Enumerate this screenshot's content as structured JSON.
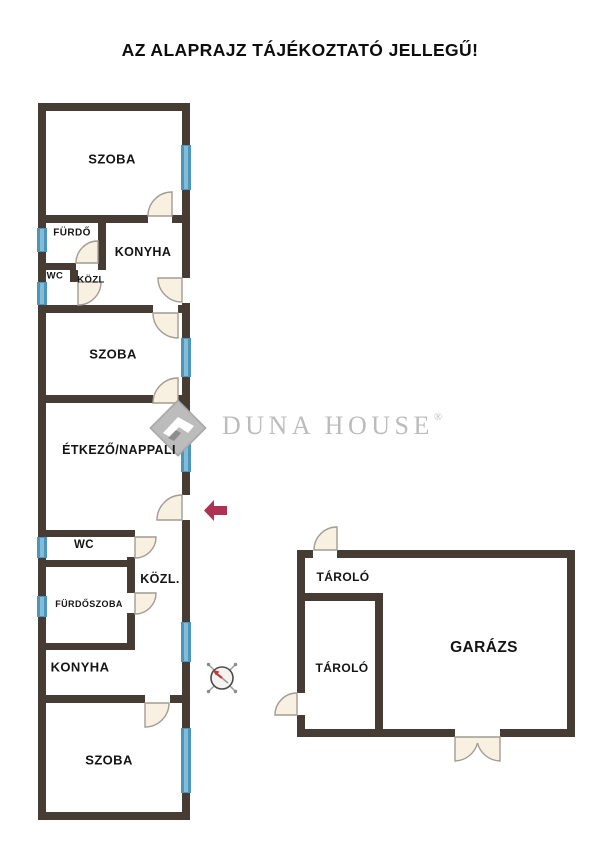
{
  "title": "AZ ALAPRAJZ TÁJÉKOZTATÓ JELLEGŰ!",
  "watermark": {
    "brand": "DUNA HOUSE",
    "registered": "®"
  },
  "floorplan": {
    "main_building": {
      "rooms": {
        "szoba_top": "SZOBA",
        "furdo": "FÜRDŐ",
        "konyha_top": "KONYHA",
        "wc_top": "WC",
        "kozl_top": "KÖZL",
        "szoba_mid": "SZOBA",
        "etkezo_nappali": "ÉTKEZŐ/NAPPALI",
        "wc_bottom": "WC",
        "furdoszoba": "FÜRDŐSZOBA",
        "kozl_bottom": "KÖZL.",
        "konyha_bottom": "KONYHA",
        "szoba_bottom": "SZOBA"
      }
    },
    "garage_building": {
      "rooms": {
        "tarolo_top": "TÁROLÓ",
        "tarolo_bottom": "TÁROLÓ",
        "garazs": "GARÁZS"
      }
    }
  },
  "colors": {
    "wall": "#463c34",
    "window_blue": "#4f94ba",
    "window_blue_light": "#82bdd7",
    "door_fill": "#f8f0e1",
    "door_stroke": "#a29c92",
    "arrow": "#b03252",
    "watermark": "#bcbcbc",
    "label": "#141414",
    "needle": "#c23b3b"
  }
}
